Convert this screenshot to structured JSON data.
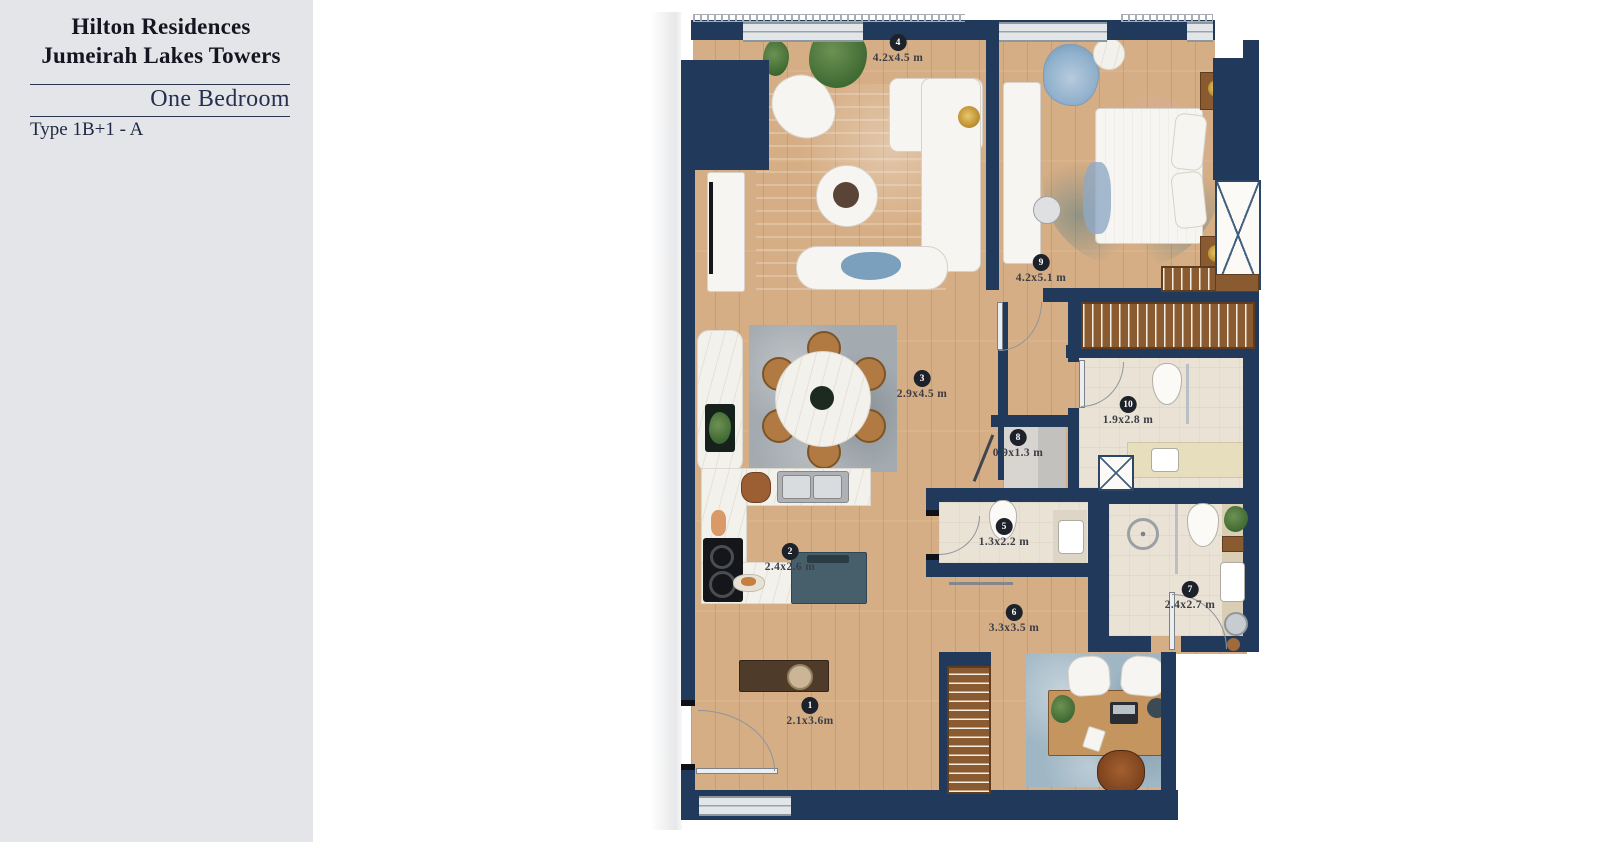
{
  "panel": {
    "title_line1": "Hilton Residences",
    "title_line2": "Jumeirah Lakes Towers",
    "subtitle": "One Bedroom",
    "type_label": "Type 1B+1 - A"
  },
  "rooms": [
    {
      "number": "1",
      "dimensions": "2.1x3.6m"
    },
    {
      "number": "2",
      "dimensions": "2.4x2.6 m"
    },
    {
      "number": "3",
      "dimensions": "2.9x4.5 m"
    },
    {
      "number": "4",
      "dimensions": "4.2x4.5 m"
    },
    {
      "number": "5",
      "dimensions": "1.3x2.2 m"
    },
    {
      "number": "6",
      "dimensions": "3.3x3.5 m"
    },
    {
      "number": "7",
      "dimensions": "2.4x2.7 m"
    },
    {
      "number": "8",
      "dimensions": "0.9x1.3 m"
    },
    {
      "number": "9",
      "dimensions": "4.2x5.1 m"
    },
    {
      "number": "10",
      "dimensions": "1.9x2.8 m"
    }
  ],
  "palette": {
    "wall_navy": "#21395a",
    "wood_floor": "#d6ae85",
    "bath_tile": "#eae2d4",
    "panel_gray": "#e4e5e9",
    "marker_black": "#1d222a",
    "island_teal": "#465f6b",
    "rail_brown": "#8a5a30"
  }
}
